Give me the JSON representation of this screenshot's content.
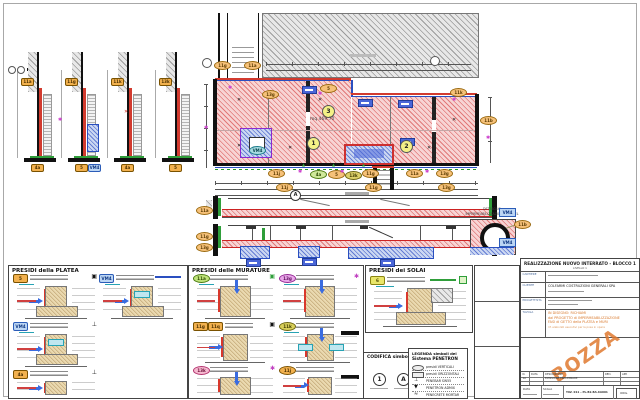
{
  "icons": {
    "cross": "✕",
    "star": "✱",
    "tri": "▲",
    "target": "▣",
    "tbar": "⊥",
    "valve": "▼",
    "wave": "≈"
  },
  "colors": {
    "membrane_red": "#d23b2f",
    "perimeter_blue": "#2a4fc0",
    "green": "#2f9e3a",
    "callout_orange": "#f6c179",
    "magenta": "#cc3ecc",
    "draft_orange": "#e07a30",
    "pink_hatch": "#f7d4d4",
    "gray_hatch": "#e8e8e8",
    "blue_hatch": "#ccd8f2"
  },
  "wall_sections": {
    "items": [
      {
        "top_badge": "11a",
        "bottom_badge": "4a"
      },
      {
        "top_badge": "11g",
        "bottom_badge": "5",
        "bottom_badge2": "VM4"
      },
      {
        "top_badge": "11k",
        "bottom_badge": "4a"
      },
      {
        "top_badge": "13k",
        "bottom_badge": "5"
      }
    ]
  },
  "plan": {
    "area_label": "mq 469.70",
    "zone_1": "1",
    "zone_2": "2",
    "zone_3": "3",
    "section_marker": "A",
    "callouts": [
      "11g",
      "11a",
      "13g",
      "5",
      "11k",
      "11b",
      "11j",
      "4a",
      "5",
      "13k",
      "11g",
      "11a",
      "13g",
      "VM4",
      "11j",
      "11g",
      "13g"
    ]
  },
  "sections_view": {
    "a_left_callout": "11a",
    "a_right_badge": "VM4",
    "b_left_callout_1": "11g",
    "b_left_callout_2": "13g",
    "b_right_badge": "VM4"
  },
  "tunnel_detail": {
    "title_line1": "DETTAGLIO",
    "title_line2": "IMPERMEABILIZZAZIONE TUNNEL",
    "callout": "11b"
  },
  "panels": {
    "platea": {
      "title": "PRESIDI della PLATEA",
      "details": [
        {
          "badge": "5"
        },
        {
          "badge": "VM4"
        },
        {
          "badge": "VM4"
        },
        {
          "badge": "4a"
        }
      ]
    },
    "murature": {
      "title": "PRESIDI delle MURATURE",
      "details": [
        {
          "badge": "11a"
        },
        {
          "badge": "13g"
        },
        {
          "badge": "11g",
          "badge2": "11q"
        },
        {
          "badge": "11k"
        },
        {
          "badge": "13k"
        },
        {
          "badge": "11j"
        }
      ]
    },
    "solai": {
      "title": "PRESIDI dei SOLAI",
      "details": [
        {
          "badge": "6"
        }
      ]
    }
  },
  "codifica": {
    "title": "CODIFICA simboli",
    "symbol_1": "1",
    "symbol_2": "A"
  },
  "legend": {
    "title_line1": "LEGENDA simboli del",
    "title_line2": "Sistema PENETRON",
    "items": [
      {
        "label": "presidi VERTICALI"
      },
      {
        "label": "presidi ORIZZONTALI"
      },
      {
        "label": "PENEBAR SW55"
      },
      {
        "label": "PENETRON ADMIX"
      },
      {
        "label": "PENECRETE MORTAR"
      }
    ]
  },
  "titleblock": {
    "project_title": "REALIZZAZIONE NUOVO INTERRATO - BLOCCO 1",
    "project_subtitle": "LIVELLO 1",
    "r1_label": "CANTIERE",
    "r2_label": "CLIENTE",
    "r3_label": "PROGETTISTA",
    "r4_label": "TAVOLA",
    "client": "COLFARMI COSTRUZIONI GENERALI SPA",
    "tavola_line1": "IN DISEGNO: RICHIAMI",
    "tavola_line2": "dal PROGETTO di IMPERMEABILIZZAZIONE",
    "tavola_line3": "FASI di GETTO della PLATEA e MURI",
    "tavola_line4": "rif. elaborati esecutivi per la posa in opera",
    "watermark": "BOZZA",
    "rev_n": "N.",
    "rev_data": "DATA",
    "rev_desc": "DESCRIZIONE",
    "rev_red": "RED.",
    "rev_app": "APP.",
    "rev_row_n": "1A",
    "rev_row_desc": "EMISSIONE PRELIMINARE",
    "footer_data_label": "DATA",
    "footer_scala_label": "SCALA",
    "footer_code": "TAV. 011 - PL.B2.BA.6A001",
    "footer_stamp": "ORIG."
  }
}
